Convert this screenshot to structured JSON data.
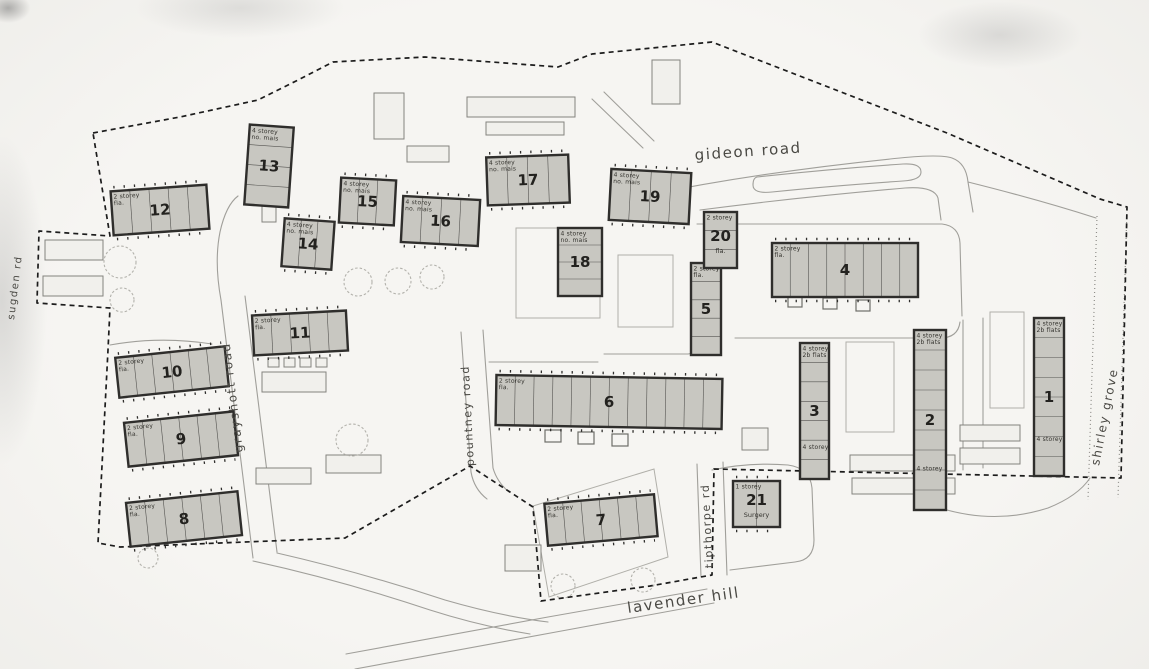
{
  "colors": {
    "paper": "#f4f3f0",
    "ink": "#2f2e2c",
    "building_fill": "#c8c7c1",
    "road_line": "#a09f9a",
    "boundary": "#1c1c1c"
  },
  "roads": [
    {
      "name": "gideon-road",
      "label": "gideon road",
      "x": 695,
      "y": 160,
      "rot": -4,
      "size": 15
    },
    {
      "name": "grayshott-road",
      "label": "grayshott road",
      "x": 243,
      "y": 452,
      "rot": -97,
      "size": 12
    },
    {
      "name": "pountney-road",
      "label": "pountney road",
      "x": 474,
      "y": 466,
      "rot": -93,
      "size": 11
    },
    {
      "name": "tipthorpe-road",
      "label": "tipthorpe rd",
      "x": 713,
      "y": 568,
      "rot": -93,
      "size": 11
    },
    {
      "name": "shirley-grove",
      "label": "shirley grove",
      "x": 1099,
      "y": 466,
      "rot": -79,
      "size": 12
    },
    {
      "name": "lavender-hill",
      "label": "lavender hill",
      "x": 628,
      "y": 613,
      "rot": -8,
      "size": 15
    },
    {
      "name": "sugden-road",
      "label": "sugden rd",
      "x": 14,
      "y": 320,
      "rot": -83,
      "size": 10
    }
  ],
  "buildings": [
    {
      "num": "1",
      "x": 1034,
      "y": 318,
      "w": 30,
      "h": 158,
      "rot": 0,
      "label": [
        "4 storey",
        "2b flats"
      ],
      "label2": "4 storey"
    },
    {
      "num": "2",
      "x": 914,
      "y": 330,
      "w": 32,
      "h": 180,
      "rot": 0,
      "label": [
        "4 storey",
        "2b flats"
      ],
      "label2": "4 storey"
    },
    {
      "num": "3",
      "x": 800,
      "y": 343,
      "w": 29,
      "h": 136,
      "rot": 0,
      "label": [
        "4 storey",
        "2b flats"
      ],
      "label2": "4 storey"
    },
    {
      "num": "4",
      "x": 772,
      "y": 243,
      "w": 146,
      "h": 54,
      "rot": 0,
      "label": [
        "2 storey",
        "fla."
      ]
    },
    {
      "num": "5",
      "x": 691,
      "y": 263,
      "w": 30,
      "h": 92,
      "rot": 0,
      "label": [
        "2 storey",
        "fla."
      ]
    },
    {
      "num": "6",
      "x": 496,
      "y": 377,
      "w": 226,
      "h": 50,
      "rot": 1,
      "label": [
        "2 storey",
        "fla."
      ]
    },
    {
      "num": "7",
      "x": 546,
      "y": 499,
      "w": 110,
      "h": 42,
      "rot": -5,
      "label": [
        "2 storey",
        "fla."
      ]
    },
    {
      "num": "8",
      "x": 128,
      "y": 497,
      "w": 112,
      "h": 44,
      "rot": -6,
      "label": [
        "2 storey",
        "fla."
      ]
    },
    {
      "num": "9",
      "x": 126,
      "y": 417,
      "w": 110,
      "h": 44,
      "rot": -6,
      "label": [
        "2 storey",
        "fla."
      ]
    },
    {
      "num": "10",
      "x": 117,
      "y": 352,
      "w": 110,
      "h": 40,
      "rot": -6,
      "label": [
        "2 storey",
        "fla."
      ]
    },
    {
      "num": "11",
      "x": 253,
      "y": 313,
      "w": 94,
      "h": 40,
      "rot": -3,
      "label": [
        "2 storey",
        "fla."
      ]
    },
    {
      "num": "12",
      "x": 112,
      "y": 188,
      "w": 96,
      "h": 44,
      "rot": -4,
      "label": [
        "2 storey",
        "fla."
      ]
    },
    {
      "num": "13",
      "x": 247,
      "y": 126,
      "w": 44,
      "h": 80,
      "rot": 4,
      "label": [
        "4 storey",
        "no. mais"
      ]
    },
    {
      "num": "14",
      "x": 283,
      "y": 220,
      "w": 50,
      "h": 48,
      "rot": 4,
      "label": [
        "4 storey",
        "no. mais"
      ]
    },
    {
      "num": "15",
      "x": 340,
      "y": 179,
      "w": 55,
      "h": 45,
      "rot": 3,
      "label": [
        "4 storey",
        "no. mais"
      ]
    },
    {
      "num": "16",
      "x": 402,
      "y": 198,
      "w": 77,
      "h": 46,
      "rot": 3,
      "label": [
        "4 storey",
        "no. mais"
      ]
    },
    {
      "num": "17",
      "x": 487,
      "y": 156,
      "w": 82,
      "h": 48,
      "rot": -2,
      "label": [
        "4 storey",
        "no. mais"
      ]
    },
    {
      "num": "18",
      "x": 558,
      "y": 228,
      "w": 44,
      "h": 68,
      "rot": 0,
      "label": [
        "4 storey",
        "no. mais"
      ]
    },
    {
      "num": "19",
      "x": 610,
      "y": 171,
      "w": 80,
      "h": 51,
      "rot": 3,
      "label": [
        "4 storey",
        "no. mais"
      ]
    },
    {
      "num": "20",
      "x": 704,
      "y": 212,
      "w": 33,
      "h": 56,
      "rot": 0,
      "label": [
        "2 storey"
      ],
      "sublabel": "fla."
    },
    {
      "num": "21",
      "x": 733,
      "y": 481,
      "w": 47,
      "h": 46,
      "rot": 0,
      "label": [
        "1 storey"
      ],
      "sublabel": "Surgery"
    }
  ]
}
